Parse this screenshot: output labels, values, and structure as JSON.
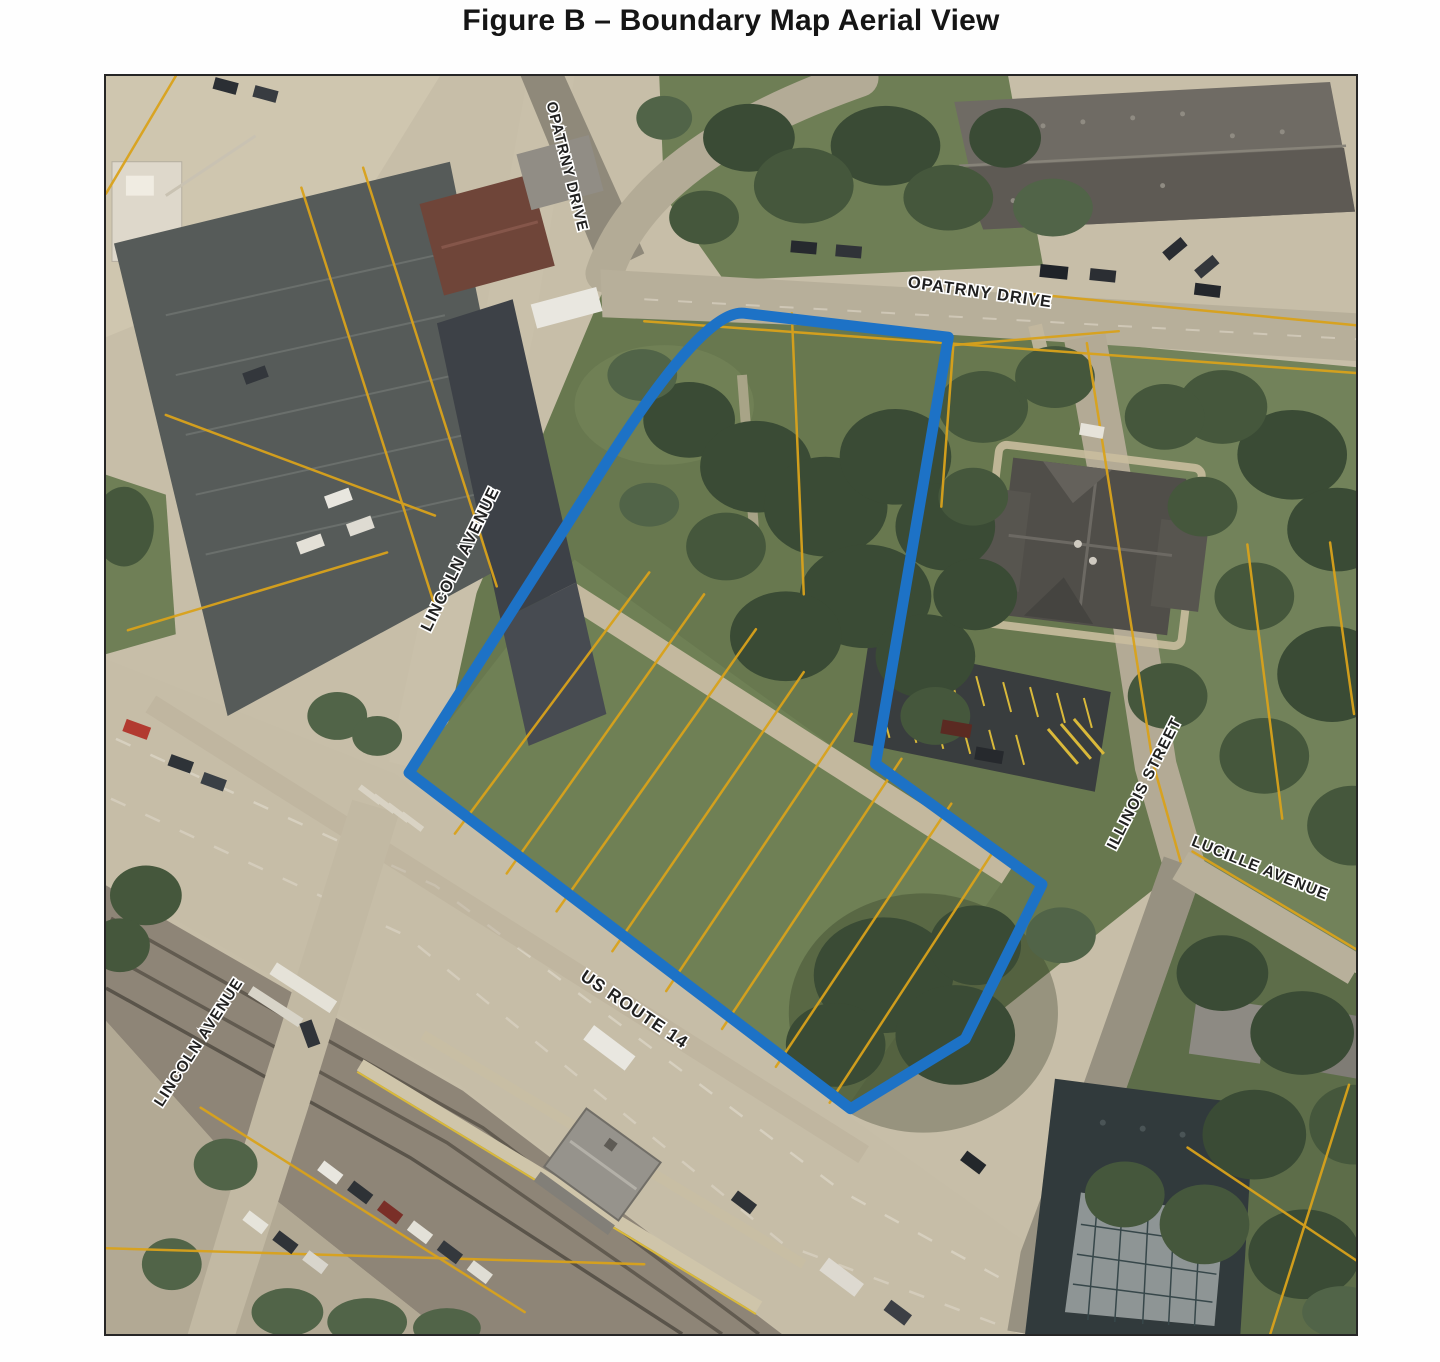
{
  "figure": {
    "title": "Figure B – Boundary Map Aerial View"
  },
  "map": {
    "labels": {
      "opatrny_top": "OPATRNY DRIVE",
      "opatrny_main": "OPATRNY DRIVE",
      "lincoln_upper": "LINCOLN AVENUE",
      "lincoln_lower": "LINCOLN AVENUE",
      "us_route_14": "US ROUTE 14",
      "illinois_street": "ILLINOIS STREET",
      "lucille_avenue": "LUCILLE AVENUE"
    },
    "colors": {
      "boundary": "#1d72c6",
      "parcel_lines": "#d9a21b"
    }
  }
}
